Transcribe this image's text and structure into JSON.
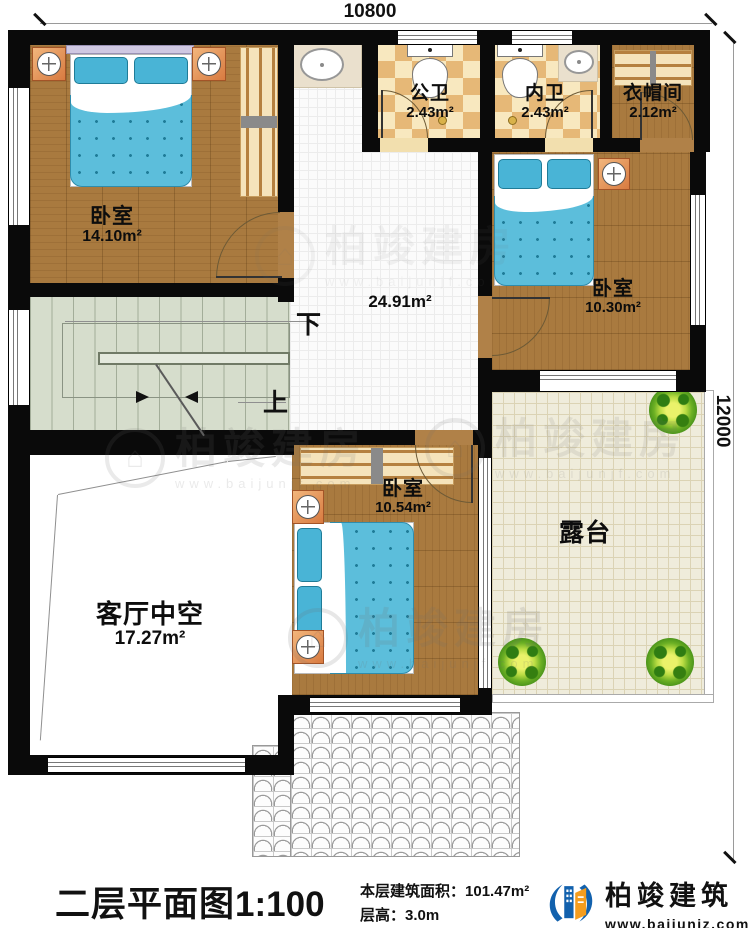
{
  "dimensions": {
    "top": "10800",
    "right": "12000"
  },
  "rooms": {
    "bedroom1": {
      "name": "卧室",
      "area": "14.10m²"
    },
    "public_bath": {
      "name": "公卫",
      "area": "2.43m²"
    },
    "ensuite_bath": {
      "name": "内卫",
      "area": "2.43m²"
    },
    "cloakroom": {
      "name": "衣帽间",
      "area": "2.12m²"
    },
    "bedroom2": {
      "name": "卧室",
      "area": "10.30m²"
    },
    "hallway": {
      "area": "24.91m²"
    },
    "bedroom3": {
      "name": "卧室",
      "area": "10.54m²"
    },
    "living_void": {
      "name": "客厅中空",
      "area": "17.27m²"
    },
    "terrace": {
      "name": "露台"
    }
  },
  "stairs": {
    "down_label": "下",
    "up_label": "上"
  },
  "watermark": {
    "brand": "柏竣建房",
    "url": "www.baijunjf.com"
  },
  "footer": {
    "title": "二层平面图",
    "scale": "1:100",
    "floor_area_label": "本层建筑面积：",
    "floor_area_value": "101.47m²",
    "floor_height_label": "层高：",
    "floor_height_value": "3.0m",
    "brand": "柏竣建筑",
    "brand_url": "www.baijunjz.com"
  },
  "colors": {
    "wall": "#0a0a0a",
    "wood_floor": "#a97a3f",
    "bed_blue": "#5cbedb",
    "stairs_green": "#d6ddcc",
    "terrace_cream": "#efecdb",
    "brand_blue": "#1261ad",
    "brand_orange": "#f59d1e"
  }
}
